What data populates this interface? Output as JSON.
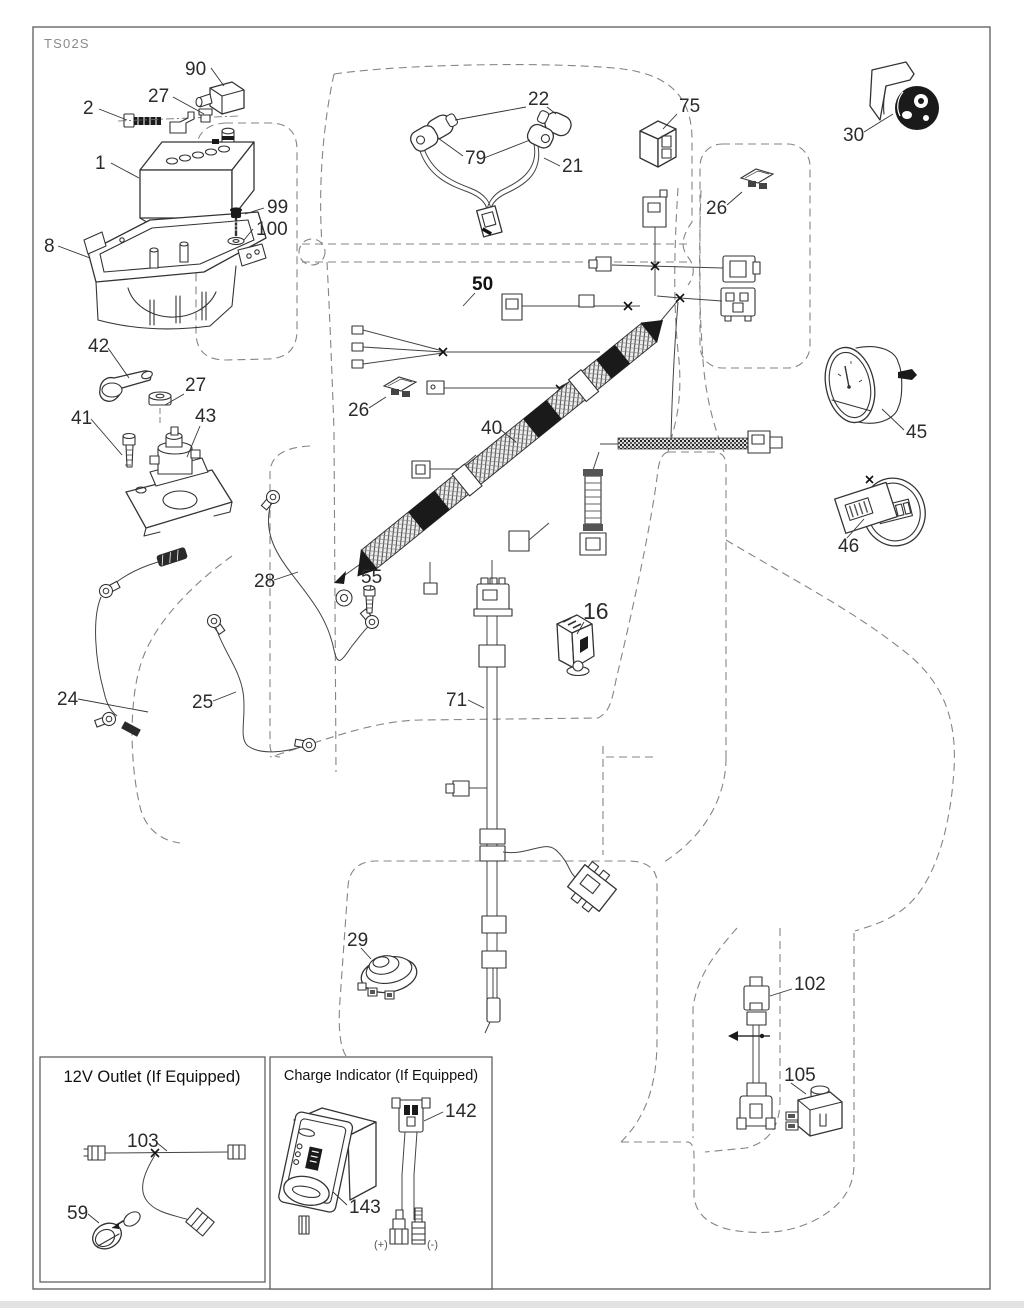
{
  "diagram_code": "TS02S",
  "insets": {
    "outlet_title": "12V Outlet (If Equipped)",
    "charge_title": "Charge Indicator (If Equipped)",
    "plus": "(+)",
    "minus": "(-)"
  },
  "callouts": [
    {
      "text": "90"
    },
    {
      "text": "2"
    },
    {
      "text": "27"
    },
    {
      "text": "1"
    },
    {
      "text": "99"
    },
    {
      "text": "100"
    },
    {
      "text": "8"
    },
    {
      "text": "42"
    },
    {
      "text": "27"
    },
    {
      "text": "41"
    },
    {
      "text": "43"
    },
    {
      "text": "26"
    },
    {
      "text": "40"
    },
    {
      "text": "50"
    },
    {
      "text": "22"
    },
    {
      "text": "79"
    },
    {
      "text": "21"
    },
    {
      "text": "75"
    },
    {
      "text": "26"
    },
    {
      "text": "30"
    },
    {
      "text": "45"
    },
    {
      "text": "46"
    },
    {
      "text": "28"
    },
    {
      "text": "55"
    },
    {
      "text": "24"
    },
    {
      "text": "25"
    },
    {
      "text": "16"
    },
    {
      "text": "71"
    },
    {
      "text": "29"
    },
    {
      "text": "102"
    },
    {
      "text": "105"
    },
    {
      "text": "103"
    },
    {
      "text": "59"
    },
    {
      "text": "142"
    },
    {
      "text": "143"
    }
  ]
}
